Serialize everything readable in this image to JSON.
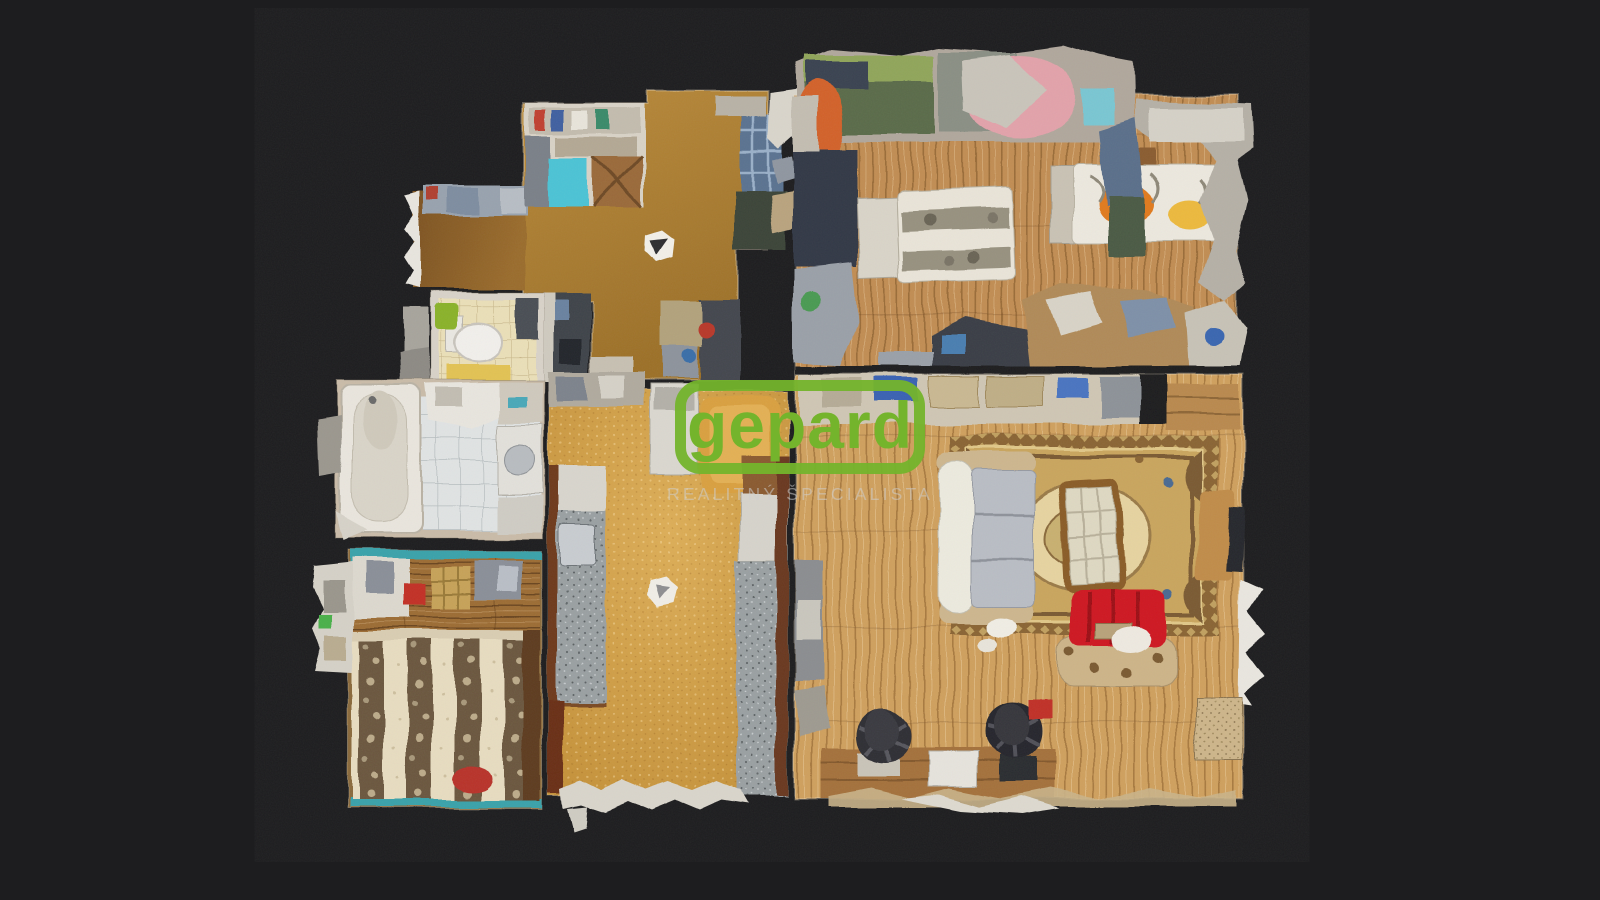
{
  "watermark": {
    "brand": "gepard",
    "tagline": "REALITNÝ ŠPECIALISTA",
    "brand_color": "#74b42c",
    "tagline_color": "rgba(205,205,205,0.55)"
  },
  "viewer": {
    "background": "#1d1d1f",
    "view_mode": "dollhouse-top-down"
  },
  "palette": {
    "wood_bedroom": "#c18d53",
    "wood_living": "#cfa05e",
    "hall_floor": "#ab7c30",
    "kitchen_floor": "#d3a04a",
    "tile_bathroom": "#e0e3e3",
    "tile_wc": "#eadfb8",
    "rug_base": "#c9a55e",
    "rug_border": "#8a6434",
    "sofa_red": "#ce1822",
    "bed_frame_teal": "#3aa2aa",
    "scan_clutter_light": "#d5d1c7",
    "scan_clutter_dark": "#3a3e46"
  },
  "scene": {
    "rooms": [
      {
        "name": "entry-hall"
      },
      {
        "name": "bedroom-top-right"
      },
      {
        "name": "wc"
      },
      {
        "name": "bathroom"
      },
      {
        "name": "bedroom-bottom-left"
      },
      {
        "name": "kitchen"
      },
      {
        "name": "living-room"
      }
    ]
  }
}
